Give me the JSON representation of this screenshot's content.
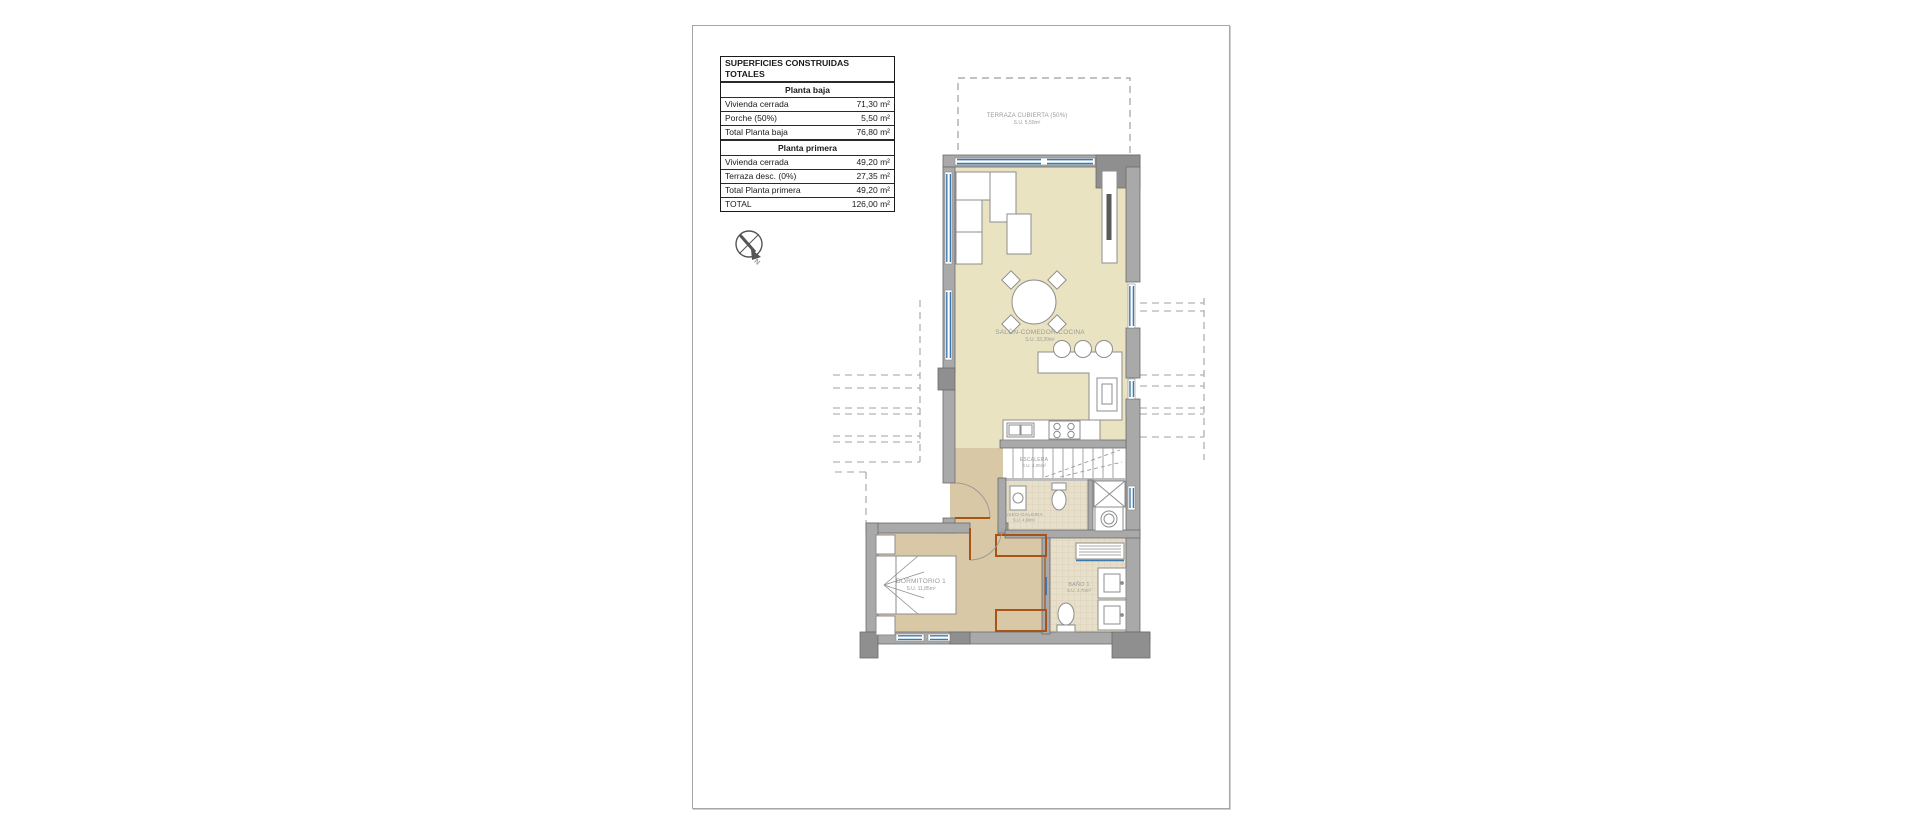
{
  "areas_table": {
    "title": "SUPERFICIES CONSTRUIDAS TOTALES",
    "sections": [
      {
        "header": "Planta baja",
        "rows": [
          {
            "label": "Vivienda cerrada",
            "value": "71,30 m²"
          },
          {
            "label": "Porche (50%)",
            "value": "5,50 m²"
          }
        ],
        "total": {
          "label": "Total Planta baja",
          "value": "76,80 m²"
        }
      },
      {
        "header": "Planta primera",
        "rows": [
          {
            "label": "Vivienda cerrada",
            "value": "49,20 m²"
          },
          {
            "label": "Terraza desc. (0%)",
            "value": "27,35 m²"
          }
        ],
        "total": {
          "label": "Total Planta primera",
          "value": "49,20 m²"
        }
      }
    ],
    "grand_total": {
      "label": "TOTAL",
      "value": "126,00 m²"
    }
  },
  "compass": {
    "north": "N"
  },
  "rooms": {
    "terraza": {
      "name": "TERRAZA CUBIERTA (50%)",
      "area": "S.U. 5,50m²"
    },
    "salon": {
      "name": "SALÓN-COMEDOR-COCINA",
      "area": "S.U. 33,20m²"
    },
    "escalera": {
      "name": "ESCALERA",
      "area": "S.U. 4,05m²"
    },
    "aseo": {
      "name": "ASEO-GALERIA",
      "area": "S.U. 4,90m²"
    },
    "dormitorio": {
      "name": "DORMITORIO 1",
      "area": "S.U. 11,85m²"
    },
    "bano": {
      "name": "BAÑO 1",
      "area": "S.U. 4,70m²"
    }
  },
  "colors": {
    "wall_gray": "#a9a9a9",
    "wall_dark": "#8f8f8f",
    "floor_salon": "#eae3c2",
    "floor_bedroom": "#d9c8a6",
    "floor_tile": "#e7dfca",
    "window_blue": "#3e79ae",
    "wardrobe_orange": "#a85418",
    "dashed_line": "#9e9e9e"
  }
}
